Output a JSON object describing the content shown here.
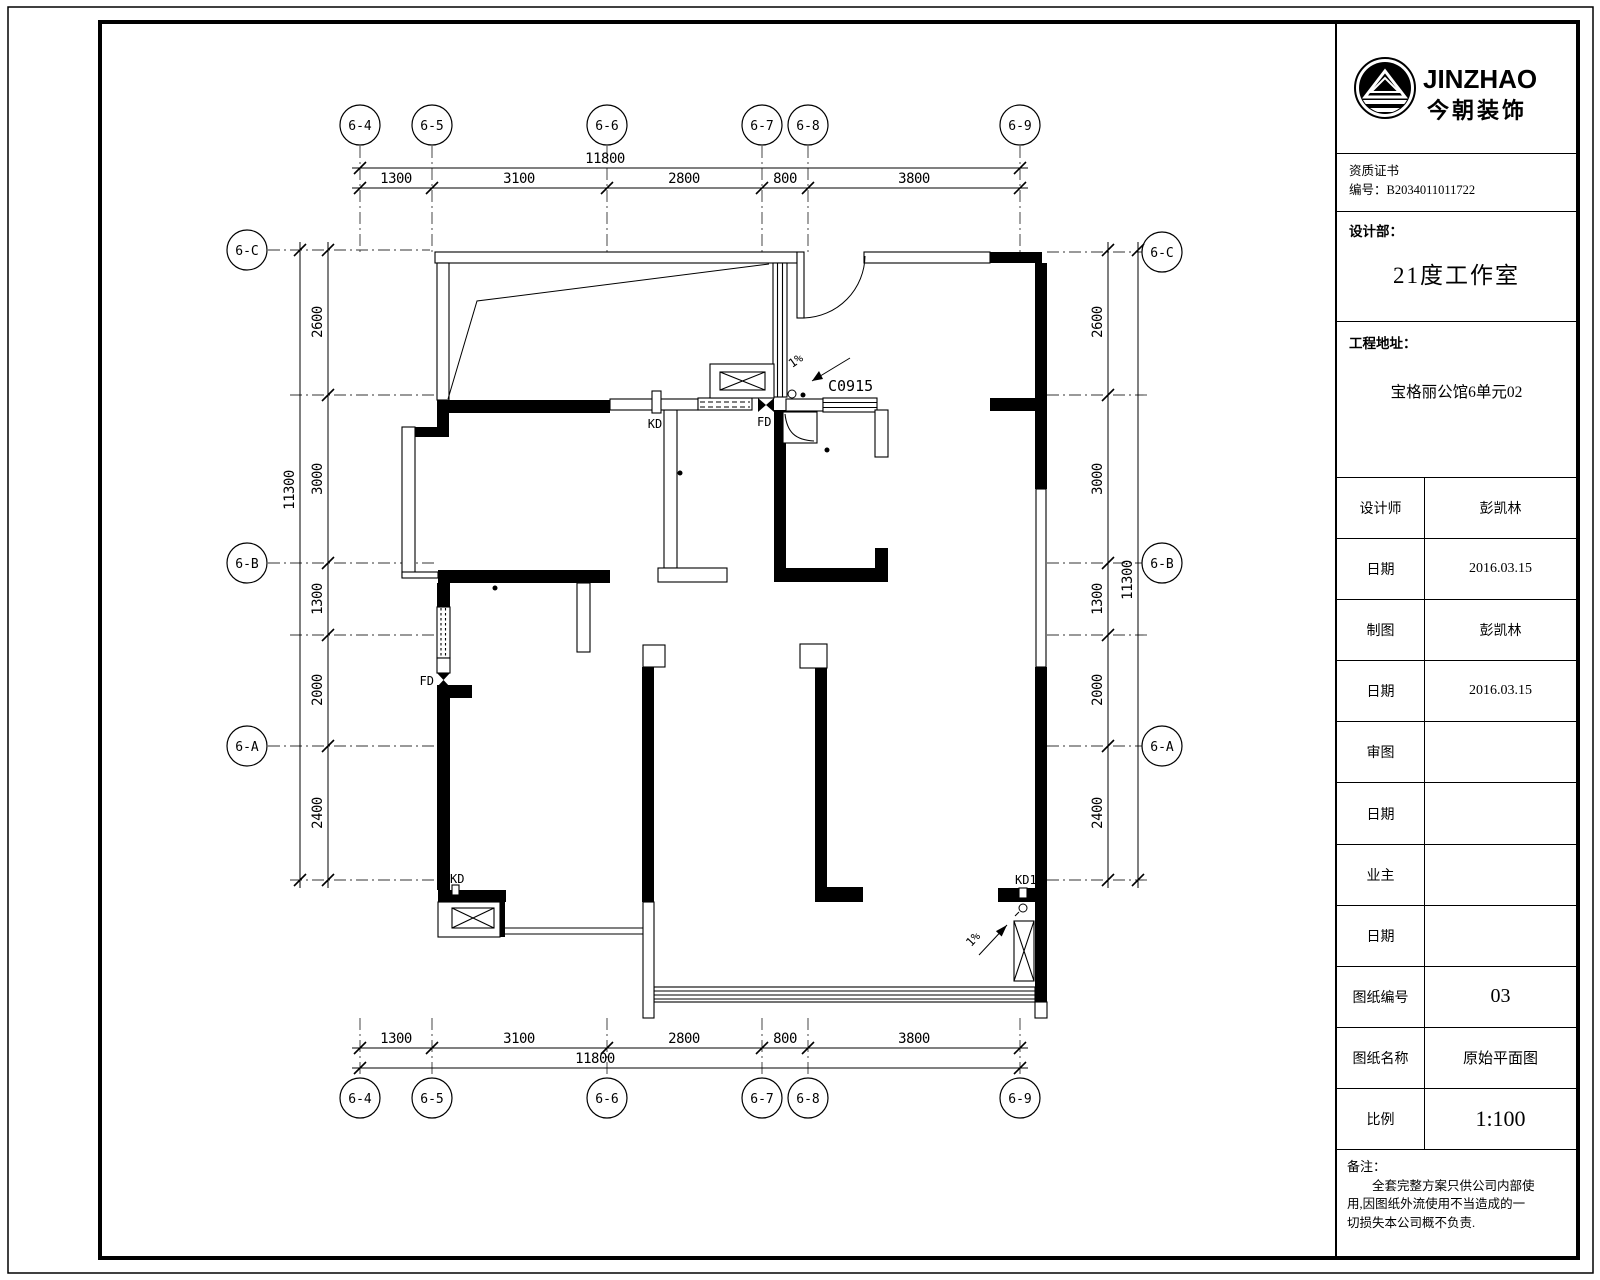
{
  "title_block": {
    "logo": {
      "brand_en": "JINZHAO",
      "brand_cn": "今朝装饰"
    },
    "cert": {
      "line1": "资质证书",
      "line2": "编号：B2034011011722"
    },
    "dept": {
      "label": "设计部：",
      "value": "21度工作室"
    },
    "address": {
      "label": "工程地址：",
      "value": "宝格丽公馆6单元02"
    },
    "rows": [
      {
        "label": "设计师",
        "value": "彭凯林"
      },
      {
        "label": "日期",
        "value": "2016.03.15"
      },
      {
        "label": "制图",
        "value": "彭凯林"
      },
      {
        "label": "日期",
        "value": "2016.03.15"
      },
      {
        "label": "审图",
        "value": ""
      },
      {
        "label": "日期",
        "value": ""
      },
      {
        "label": "业主",
        "value": ""
      },
      {
        "label": "日期",
        "value": ""
      },
      {
        "label": "图纸编号",
        "value": "03"
      },
      {
        "label": "图纸名称",
        "value": "原始平面图"
      },
      {
        "label": "比例",
        "value": "1:100"
      }
    ],
    "note": {
      "label": "备注：",
      "lines": [
        "全套完整方案只供公司内部使",
        "用,因图纸外流使用不当造成的一",
        "切损失本公司概不负责."
      ]
    }
  },
  "plan": {
    "axes_top": [
      "6-4",
      "6-5",
      "6-6",
      "6-7",
      "6-8",
      "6-9"
    ],
    "axes_left": [
      "6-C",
      "6-B",
      "6-A"
    ],
    "dims_h": {
      "total": "11800",
      "segments": [
        "1300",
        "3100",
        "2800",
        "800",
        "3800"
      ]
    },
    "dims_v": {
      "total": "11300",
      "segments": [
        "2600",
        "3000",
        "1300",
        "2000",
        "2400"
      ]
    },
    "labels": {
      "kd": "KD",
      "fd": "FD",
      "kd1": "KD1",
      "window_code": "C0915",
      "slope": "1%"
    }
  }
}
